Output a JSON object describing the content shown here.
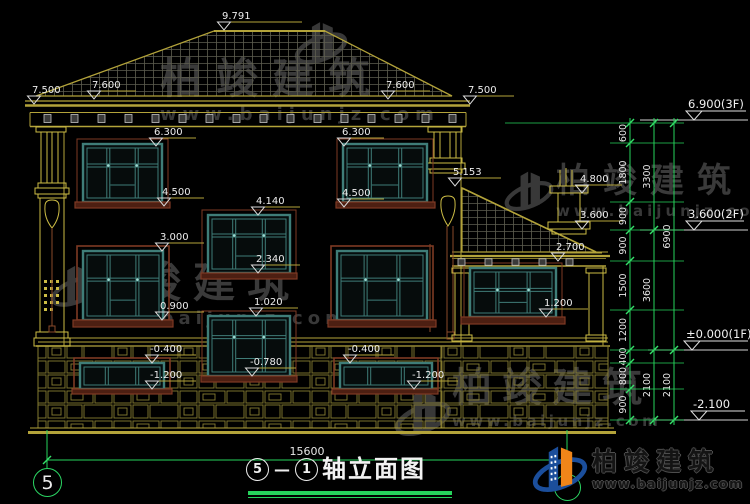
{
  "drawing_title": {
    "bubble_left": "5",
    "dash": "—",
    "bubble_right": "1",
    "name": "轴立面图"
  },
  "axis_bubbles": {
    "bottom_left": "5",
    "bottom_right": "1"
  },
  "bottom_dimension": "15600",
  "watermark": {
    "brand": "柏竣建筑",
    "url": "www.baijunjz.com"
  },
  "footer_logo": {
    "brand": "柏竣建筑",
    "url": "www.baijunjz.com"
  },
  "colors": {
    "line_yellow": "#b3a33a",
    "bright_yellow": "#ccbc45",
    "green": "#26d35c",
    "teal_window": "#3f7d78",
    "brown": "#7e3a24",
    "white_text": "#ededed"
  },
  "elevation_markers": [
    {
      "v": "9.791",
      "tx": 224,
      "ly": 30,
      "bar": 78
    },
    {
      "v": "7.500",
      "tx": 34,
      "ly": 104,
      "bar": 44
    },
    {
      "v": "7.600",
      "tx": 94,
      "ly": 99,
      "bar": 42
    },
    {
      "v": "7.600",
      "tx": 388,
      "ly": 99,
      "bar": 42
    },
    {
      "v": "7.500",
      "tx": 470,
      "ly": 104,
      "bar": 44
    },
    {
      "v": "6.300",
      "tx": 156,
      "ly": 146,
      "bar": 40
    },
    {
      "v": "4.500",
      "tx": 164,
      "ly": 206,
      "bar": 40
    },
    {
      "v": "6.300",
      "tx": 344,
      "ly": 146,
      "bar": 40
    },
    {
      "v": "4.500",
      "tx": 344,
      "ly": 207,
      "bar": 40
    },
    {
      "v": "5.153",
      "tx": 455,
      "ly": 186,
      "bar": 46
    },
    {
      "v": "4.140",
      "tx": 258,
      "ly": 215,
      "bar": 42
    },
    {
      "v": "2.340",
      "tx": 258,
      "ly": 273,
      "bar": 42
    },
    {
      "v": "3.000",
      "tx": 162,
      "ly": 251,
      "bar": 42
    },
    {
      "v": "0.900",
      "tx": 162,
      "ly": 320,
      "bar": 42
    },
    {
      "v": "1.020",
      "tx": 256,
      "ly": 316,
      "bar": 42
    },
    {
      "v": "-0.780",
      "tx": 252,
      "ly": 376,
      "bar": 44
    },
    {
      "v": "2.700",
      "tx": 558,
      "ly": 261,
      "bar": 44
    },
    {
      "v": "1.200",
      "tx": 546,
      "ly": 317,
      "bar": 42
    },
    {
      "v": "4.800",
      "tx": 582,
      "ly": 193,
      "bar": 40
    },
    {
      "v": "3.600",
      "tx": 582,
      "ly": 229,
      "bar": 40
    },
    {
      "v": "-0.400",
      "tx": 152,
      "ly": 363,
      "bar": 44
    },
    {
      "v": "-1.200",
      "tx": 152,
      "ly": 389,
      "bar": 44
    },
    {
      "v": "-0.400",
      "tx": 350,
      "ly": 363,
      "bar": 44
    },
    {
      "v": "-1.200",
      "tx": 414,
      "ly": 389,
      "bar": 44
    }
  ],
  "right_level_markers": [
    {
      "v": "6.900(3F)",
      "tx": 694,
      "ly": 120,
      "bar": 52,
      "lx": 640
    },
    {
      "v": "3.600(2F)",
      "tx": 694,
      "ly": 230,
      "bar": 50,
      "lx": 640
    },
    {
      "v": "±0.000(1F)",
      "tx": 692,
      "ly": 350,
      "bar": 56,
      "lx": 648
    },
    {
      "v": "-2.100",
      "tx": 699,
      "ly": 420,
      "bar": 46,
      "lx": 655
    }
  ],
  "dim_chains": [
    {
      "x": 630,
      "segments": [
        {
          "v": "600",
          "y1": 123,
          "y2": 143
        },
        {
          "v": "1800",
          "y1": 143,
          "y2": 202
        },
        {
          "v": "900",
          "y1": 202,
          "y2": 230
        },
        {
          "v": "900",
          "y1": 230,
          "y2": 261
        },
        {
          "v": "1500",
          "y1": 261,
          "y2": 310
        },
        {
          "v": "1200",
          "y1": 310,
          "y2": 350
        },
        {
          "v": "400",
          "y1": 350,
          "y2": 363
        },
        {
          "v": "800",
          "y1": 363,
          "y2": 389
        },
        {
          "v": "900",
          "y1": 389,
          "y2": 420
        }
      ]
    },
    {
      "x": 654,
      "segments": [
        {
          "v": "3300",
          "y1": 123,
          "y2": 230
        },
        {
          "v": "3600",
          "y1": 230,
          "y2": 350
        },
        {
          "v": "2100",
          "y1": 350,
          "y2": 420
        }
      ]
    },
    {
      "x": 674,
      "segments": [
        {
          "v": "6900",
          "y1": 123,
          "y2": 350
        },
        {
          "v": "2100",
          "y1": 350,
          "y2": 420
        }
      ]
    }
  ]
}
